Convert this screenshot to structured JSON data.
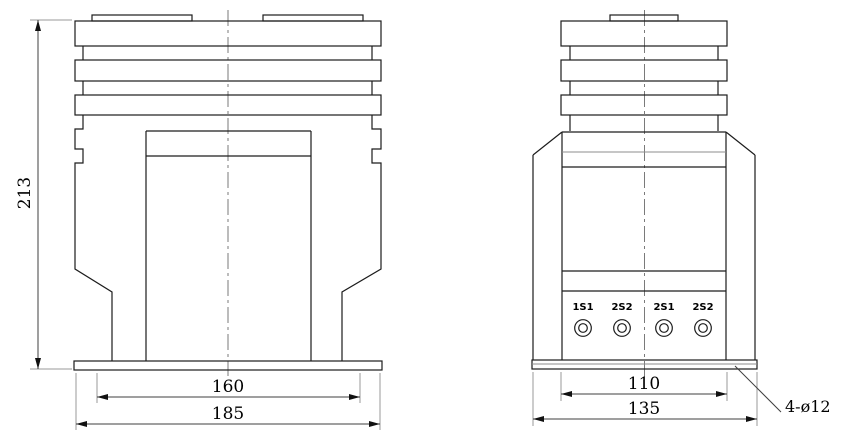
{
  "drawing_type": "technical-dimension-drawing",
  "colors": {
    "background": "#ffffff",
    "outline": "#1c1c1c",
    "dimension_line": "#3f3f3f",
    "extension_line": "#9a9a9a",
    "centerline": "#7a7a7a",
    "text": "#000000"
  },
  "front": {
    "dim_height": "213",
    "dim_inner": "160",
    "dim_outer": "185"
  },
  "side": {
    "dim_inner": "110",
    "dim_outer": "135",
    "hole_note": "4-ø12",
    "terminals": [
      "1S1",
      "2S2",
      "2S1",
      "2S2"
    ]
  }
}
